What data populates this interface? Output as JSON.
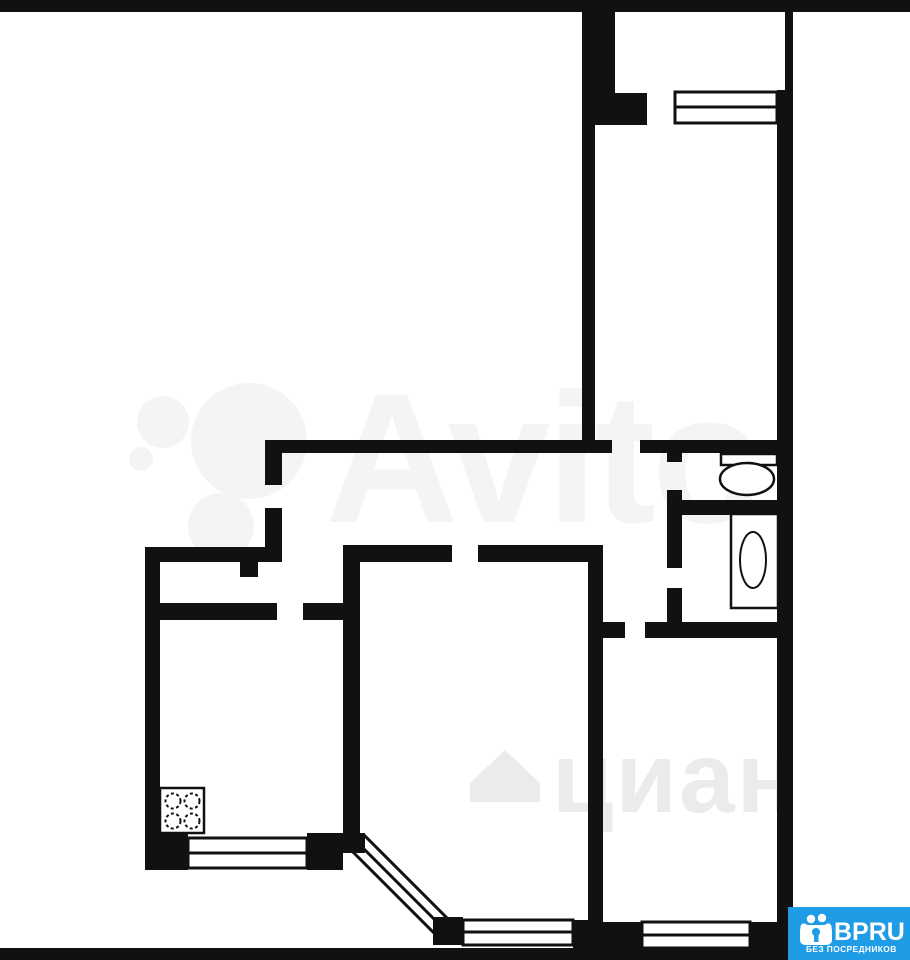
{
  "plan": {
    "background": "#ffffff",
    "wall_color": "#111111"
  },
  "watermarks": {
    "avito": {
      "text": "Avito",
      "color": "#f4f4f4"
    },
    "cian": {
      "text": "циан",
      "color": "#ebebeb"
    }
  },
  "logo": {
    "brand": "BPRU",
    "tagline": "БЕЗ ПОСРЕДНИКОВ",
    "background": "#1e9ce5",
    "text_color": "#ffffff"
  }
}
